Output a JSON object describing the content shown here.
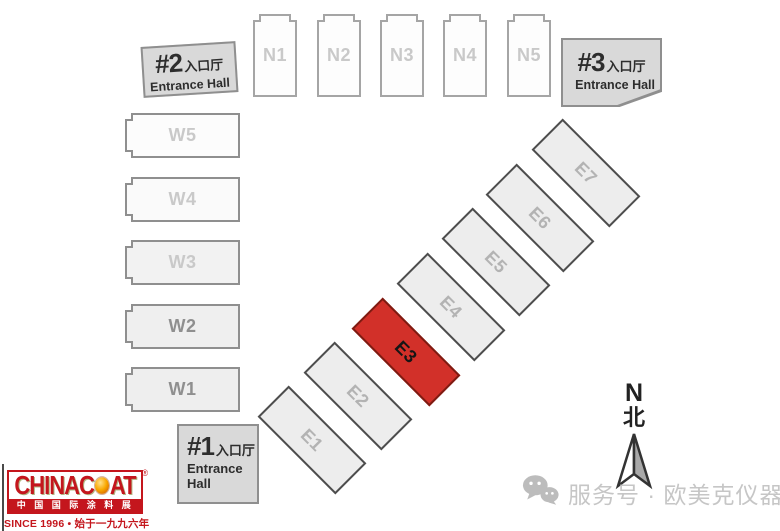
{
  "map": {
    "halls": {
      "N1": "N1",
      "N2": "N2",
      "N3": "N3",
      "N4": "N4",
      "N5": "N5",
      "W1": "W1",
      "W2": "W2",
      "W3": "W3",
      "W4": "W4",
      "W5": "W5",
      "E1": "E1",
      "E2": "E2",
      "E3": "E3",
      "E4": "E4",
      "E5": "E5",
      "E6": "E6",
      "E7": "E7"
    },
    "highlighted_hall": "E3",
    "highlight_color": "#d23029",
    "entrances": {
      "no1": {
        "number": "#1",
        "cn": "入口厅",
        "en_line1": "Entrance",
        "en_line2": "Hall"
      },
      "no2": {
        "number": "#2",
        "cn": "入口厅",
        "en": "Entrance Hall"
      },
      "no3": {
        "number": "#3",
        "cn": "入口厅",
        "en": "Entrance Hall"
      }
    },
    "compass": {
      "letter": "N",
      "cn": "北"
    }
  },
  "logo": {
    "brand": "CHINACOAT",
    "brand_left": "CHINAC",
    "brand_right": "AT",
    "registered": "®",
    "cn_band": "中国国际涂料展",
    "tagline": "SINCE 1996 • 始于一九九六年",
    "brand_color": "#c4161d"
  },
  "watermark": {
    "text": "服务号 · 欧美克仪器"
  }
}
